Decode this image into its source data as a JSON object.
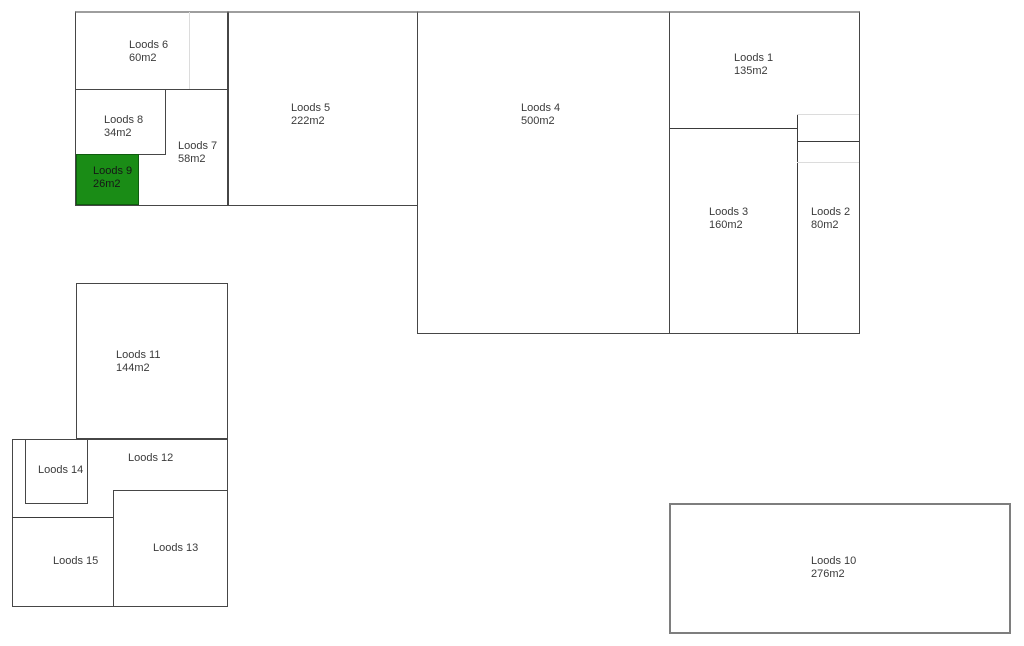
{
  "colors": {
    "highlight": "#1a8c16",
    "text": "#3b3b3b",
    "wall": "#464646",
    "wall_light": "#dcdcdc"
  },
  "rooms": [
    {
      "label": "Loods 1",
      "area": "135m2",
      "highlighted": false
    },
    {
      "label": "Loods 2",
      "area": "80m2",
      "highlighted": false
    },
    {
      "label": "Loods 3",
      "area": "160m2",
      "highlighted": false
    },
    {
      "label": "Loods 4",
      "area": "500m2",
      "highlighted": false
    },
    {
      "label": "Loods 5",
      "area": "222m2",
      "highlighted": false
    },
    {
      "label": "Loods 6",
      "area": "60m2",
      "highlighted": false
    },
    {
      "label": "Loods 7",
      "area": "58m2",
      "highlighted": false
    },
    {
      "label": "Loods 8",
      "area": "34m2",
      "highlighted": false
    },
    {
      "label": "Loods 9",
      "area": "26m2",
      "highlighted": true
    },
    {
      "label": "Loods 10",
      "area": "276m2",
      "highlighted": false
    },
    {
      "label": "Loods 11",
      "area": "144m2",
      "highlighted": false
    },
    {
      "label": "Loods 12",
      "area": "",
      "highlighted": false
    },
    {
      "label": "Loods 13",
      "area": "",
      "highlighted": false
    },
    {
      "label": "Loods 14",
      "area": "",
      "highlighted": false
    },
    {
      "label": "Loods 15",
      "area": "",
      "highlighted": false
    }
  ]
}
